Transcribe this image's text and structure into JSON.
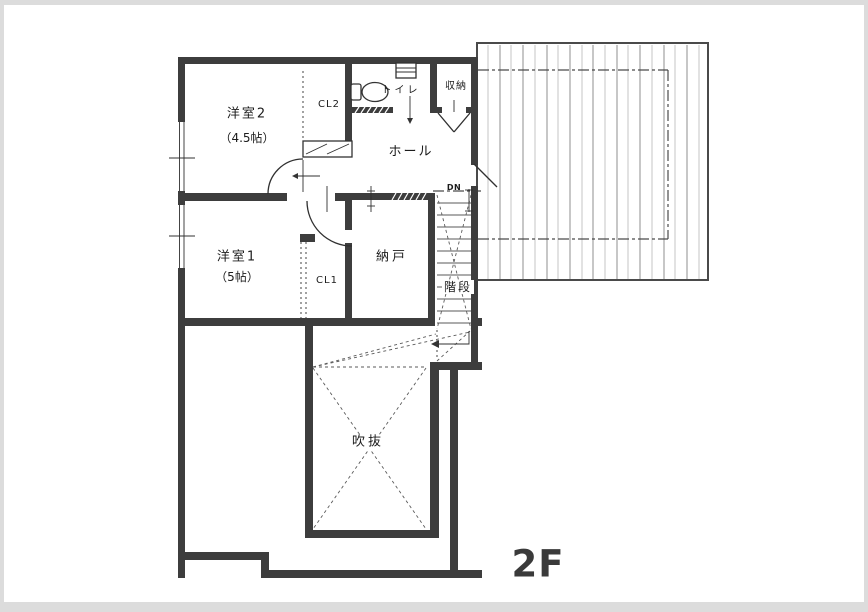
{
  "floor_plan": {
    "floor_label": "2F",
    "rooms": {
      "yoshitsu2": {
        "name": "洋室2",
        "size": "（4.5帖）"
      },
      "yoshitsu1": {
        "name": "洋室1",
        "size": "（5帖）"
      },
      "cl2": {
        "name": "CL2"
      },
      "cl1": {
        "name": "CL1"
      },
      "toilet": {
        "name": "トイレ"
      },
      "storage": {
        "name": "収納"
      },
      "hall": {
        "name": "ホール"
      },
      "nando": {
        "name": "納戸"
      },
      "stairs": {
        "name": "階段"
      },
      "void": {
        "name": "吹抜"
      },
      "stairs_direction": {
        "label": "DN"
      }
    },
    "colors": {
      "wall": "#3d3d3d",
      "line": "#303030",
      "background": "#dcdcdc",
      "paper": "#ffffff",
      "text": "#1c1c1c",
      "roof_hatch_light": "#c6c6c6",
      "roof_hatch_dark": "#8f8f8f",
      "floor_label": "#3a3a3a"
    }
  }
}
